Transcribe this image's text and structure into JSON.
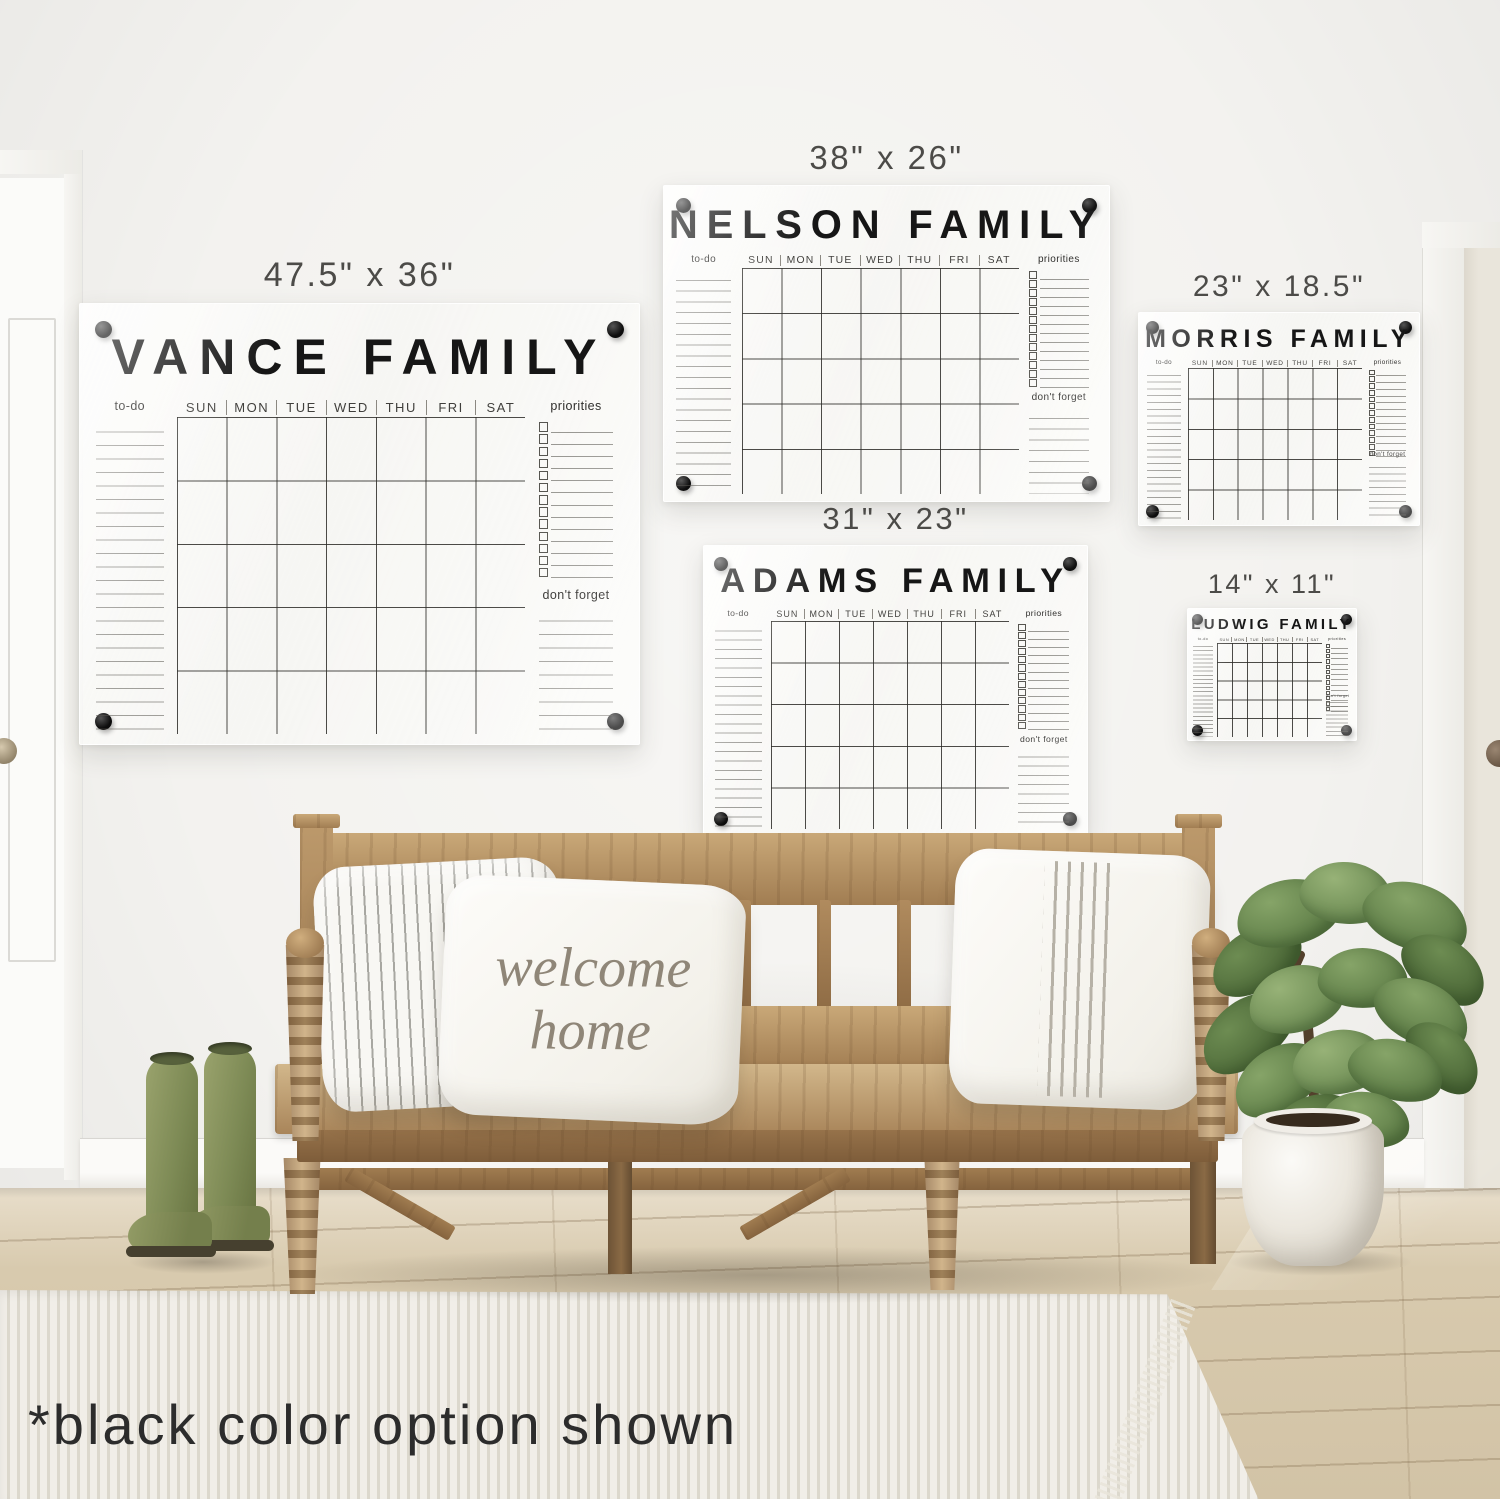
{
  "caption": "*black color option shown",
  "days": [
    "SUN",
    "MON",
    "TUE",
    "WED",
    "THU",
    "FRI",
    "SAT"
  ],
  "section_labels": {
    "todo": "to-do",
    "priorities": "priorities",
    "dont_forget": "don't forget"
  },
  "pillow": {
    "line1": "welcome",
    "line2": "home"
  },
  "calendars": [
    {
      "family": "VANCE FAMILY",
      "size": "47.5\" x 36\""
    },
    {
      "family": "NELSON FAMILY",
      "size": "38\" x 26\""
    },
    {
      "family": "MORRIS FAMILY",
      "size": "23\" x 18.5\""
    },
    {
      "family": "ADAMS FAMILY",
      "size": "31\" x 23\""
    },
    {
      "family": "LUDWIG FAMILY",
      "size": "14\" x 11\""
    }
  ],
  "colors": {
    "calendar_text": "#161616",
    "standoff": "#0d0d0d",
    "wall": "#f3f2ef",
    "bench_wood": "#b8966a",
    "boots_green": "#7d8a55",
    "rug": "#eceae3"
  }
}
